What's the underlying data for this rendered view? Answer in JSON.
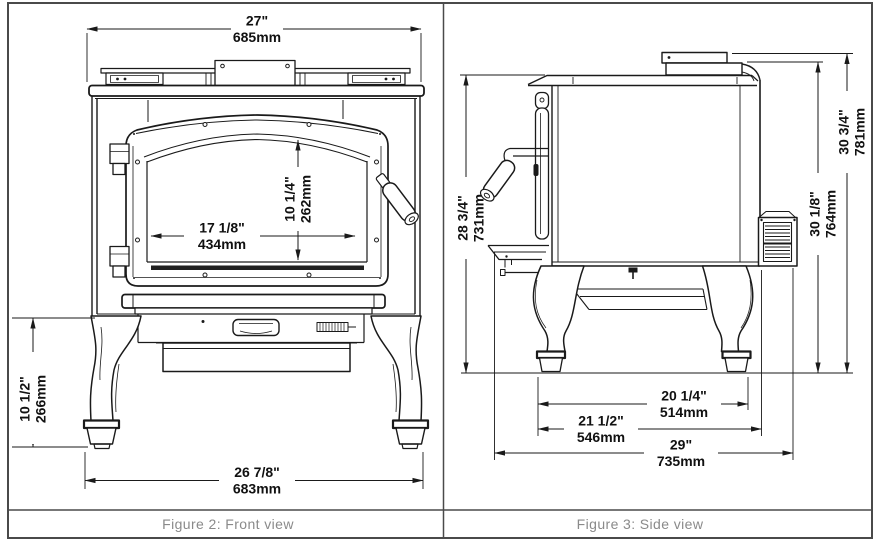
{
  "front_view": {
    "caption": "Figure 2: Front view",
    "dim_top_width": {
      "in": "27\"",
      "mm": "685mm"
    },
    "dim_glass_width": {
      "in": "17 1/8\"",
      "mm": "434mm"
    },
    "dim_glass_height": {
      "in": "10 1/4\"",
      "mm": "262mm"
    },
    "dim_leg_height": {
      "in": "10 1/2\"",
      "mm": "266mm"
    },
    "dim_base_width": {
      "in": "26 7/8\"",
      "mm": "683mm"
    }
  },
  "side_view": {
    "caption": "Figure 3: Side view",
    "dim_height_front": {
      "in": "28 3/4\"",
      "mm": "731mm"
    },
    "dim_height_flue": {
      "in": "30 1/8\"",
      "mm": "764mm"
    },
    "dim_overall_height": {
      "in": "30 3/4\"",
      "mm": "781mm"
    },
    "dim_leg_spacing": {
      "in": "20 1/4\"",
      "mm": "514mm"
    },
    "dim_body_depth": {
      "in": "21 1/2\"",
      "mm": "546mm"
    },
    "dim_overall_depth": {
      "in": "29\"",
      "mm": "735mm"
    }
  },
  "colors": {
    "line": "#1a1a1a",
    "caption_text": "#8a8a8a",
    "frame": "#4a4a4a",
    "background": "#ffffff"
  }
}
